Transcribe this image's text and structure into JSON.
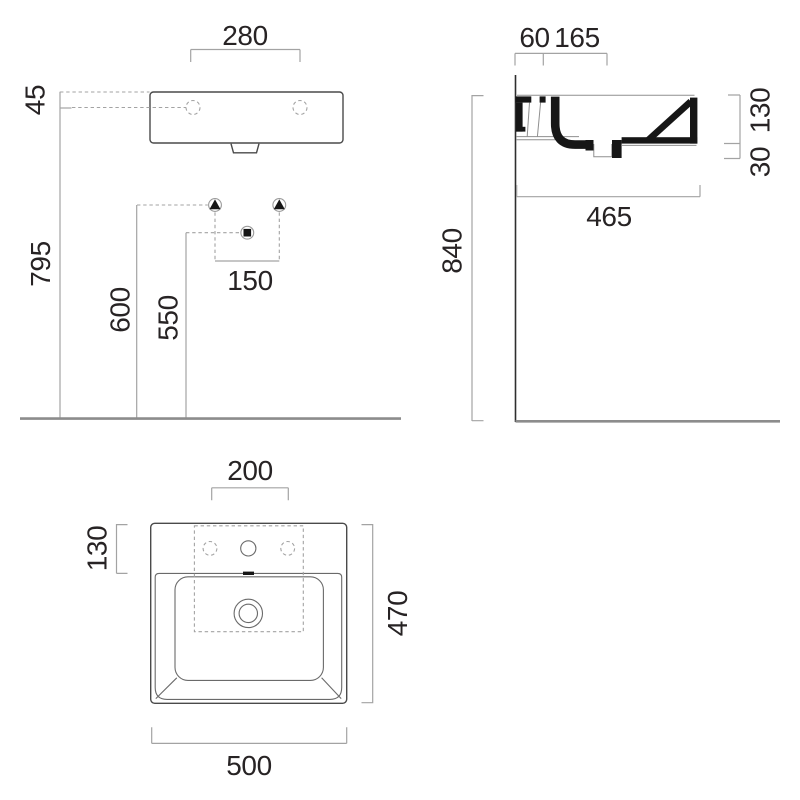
{
  "page": {
    "title": "Washbasin technical dimension drawing",
    "background": "#ffffff"
  },
  "style": {
    "ink": "#272324",
    "outline_color": "#4a4a4a",
    "dimension_line_color": "#a3a3a3",
    "section_fill": "#161616",
    "floor_line_color": "#8c8c8c"
  },
  "front_view": {
    "name": "front elevation",
    "dims": {
      "tap_holes_width": "280",
      "rim_to_tap_axis": "45",
      "floor_to_tap_axis": "795",
      "floor_to_brackets": "600",
      "floor_to_waste": "550",
      "bracket_spacing": "150"
    }
  },
  "side_view": {
    "name": "side section",
    "dims": {
      "wall_to_tap": "60",
      "tap_to_front": "165",
      "floor_to_rim": "840",
      "basin_depth": "465",
      "front_height": "130",
      "drain_lip": "30"
    }
  },
  "plan_view": {
    "name": "plan view",
    "dims": {
      "tap_hole_spacing": "200",
      "back_edge_to_bowl": "130",
      "overall_depth": "470",
      "overall_width": "500"
    }
  }
}
